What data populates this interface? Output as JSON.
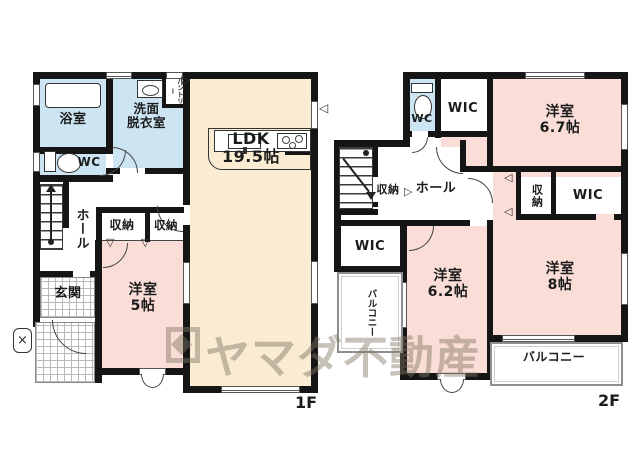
{
  "plan_title": "floor-plan",
  "floor1": {
    "label": "1F",
    "bath": "浴室",
    "washroom_l1": "洗面",
    "washroom_l2": "脱衣室",
    "pantry": "パントリー",
    "wc": "WC",
    "hall": "ホール",
    "storage_a": "収納",
    "storage_b": "収納",
    "entrance": "玄関",
    "western5_name": "洋室",
    "western5_size": "5帖",
    "ldk_name": "LDK",
    "ldk_size": "19.5帖"
  },
  "floor2": {
    "label": "2F",
    "wc": "WC",
    "wic_top": "WIC",
    "western67_name": "洋室",
    "western67_size": "6.7帖",
    "storage_hall": "収納",
    "hall": "ホール",
    "storage_mid": "収納",
    "wic_right": "WIC",
    "wic_left": "WIC",
    "balcony_left": "バルコニー",
    "western62_name": "洋室",
    "western62_size": "6.2帖",
    "western8_name": "洋室",
    "western8_size": "8帖",
    "balcony_bottom": "バルコニー"
  },
  "watermark": {
    "text": "ヤマダ不動産"
  },
  "icons": {
    "tri_left": "◁",
    "tri_right": "▷",
    "tri_down": "▽",
    "cross": "×"
  },
  "colors": {
    "room_pink": "#f9ddd6",
    "room_cream": "#faecd2",
    "room_blue": "#cde4f3",
    "wall": "#151515",
    "watermark": "rgba(128,117,99,0.45)"
  }
}
